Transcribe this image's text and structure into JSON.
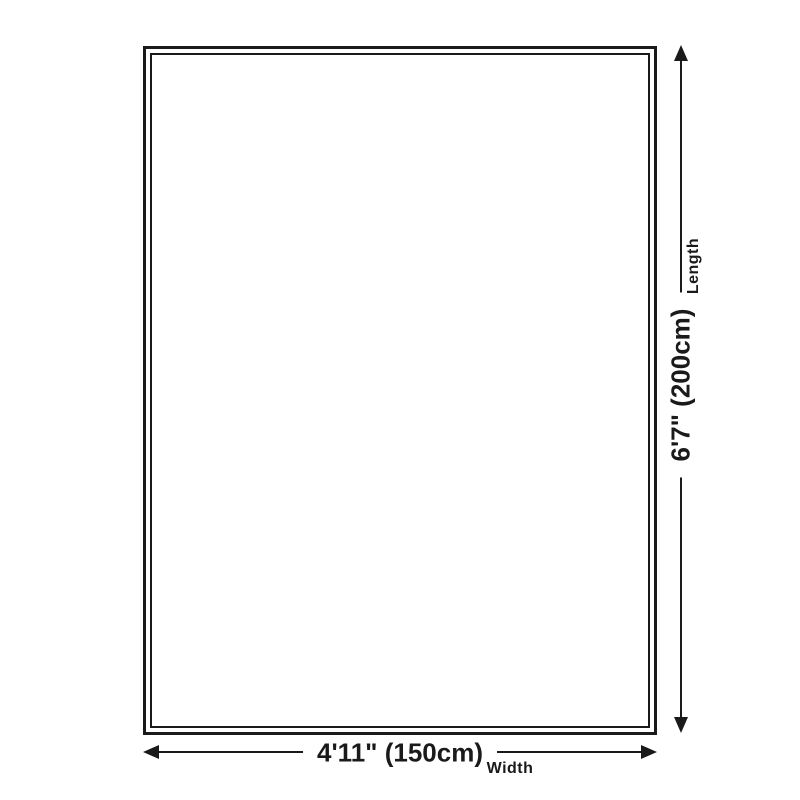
{
  "diagram": {
    "type": "product-dimensions",
    "background_color": "#ffffff",
    "line_color": "#1a1a1a",
    "length": {
      "value": "6'7\" (200cm)",
      "caption": "Length"
    },
    "width": {
      "value": "4'11\" (150cm)",
      "caption": "Width"
    },
    "icons": {
      "up": "arrow-up-icon",
      "down": "arrow-down-icon",
      "left": "arrow-left-icon",
      "right": "arrow-right-icon"
    }
  }
}
